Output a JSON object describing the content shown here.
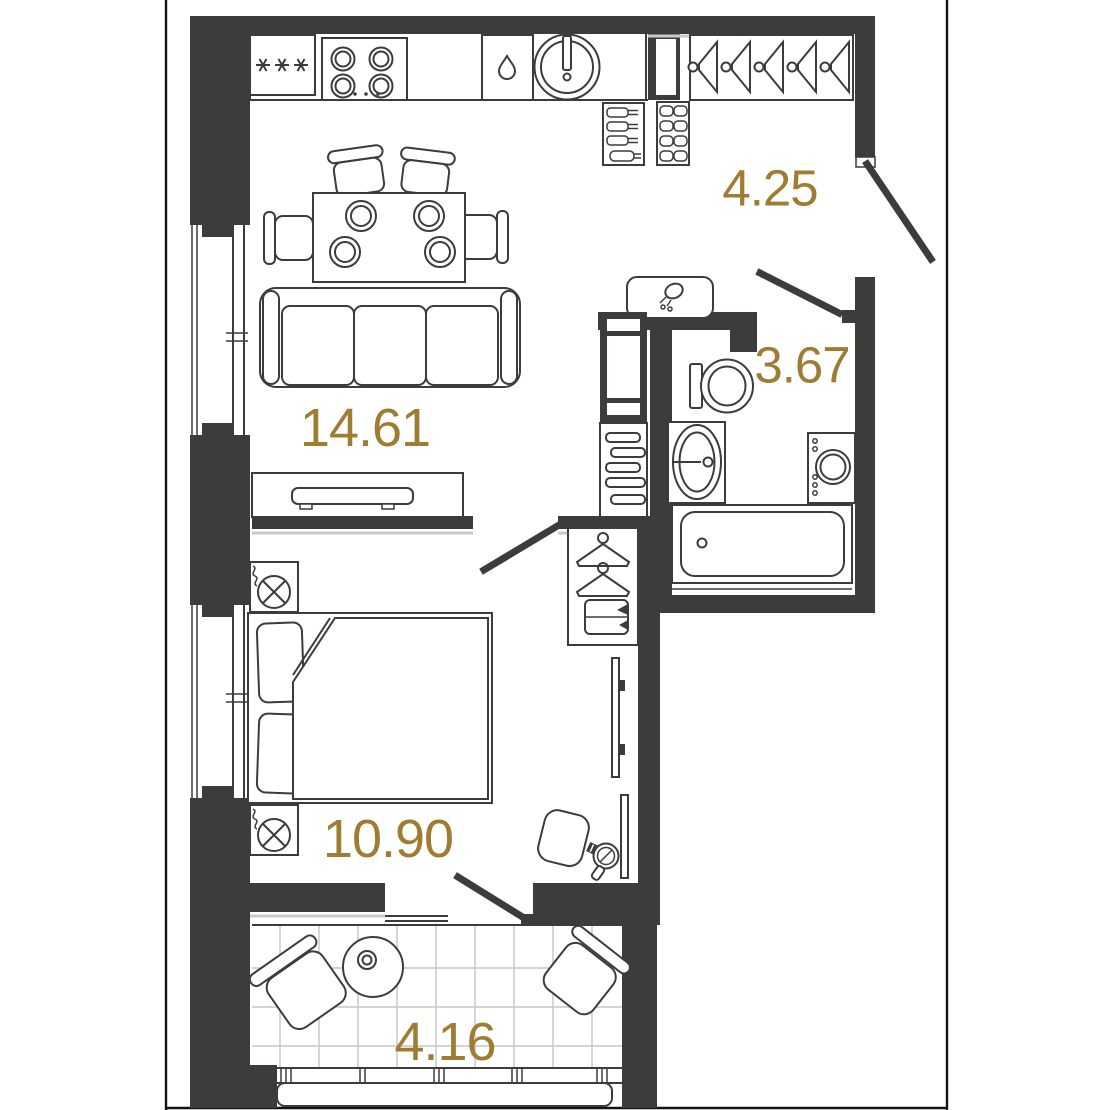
{
  "floorplan": {
    "rooms": [
      {
        "name": "kitchen-living-room",
        "area_label": "14.61"
      },
      {
        "name": "hallway",
        "area_label": "4.25"
      },
      {
        "name": "bathroom",
        "area_label": "3.67"
      },
      {
        "name": "bedroom",
        "area_label": "10.90"
      },
      {
        "name": "balcony",
        "area_label": "4.16"
      }
    ],
    "colors": {
      "wall": "#3d3c3a",
      "area_text": "#9e7d33",
      "outline": "#3d3c3a",
      "frame": "#141414",
      "tile_grid": "#c5c5c5",
      "shadow": "#cbcac8"
    },
    "fixtures": [
      "fridge-icon",
      "stove-icon",
      "dishwasher-icon",
      "sink-icon",
      "wine-rack-icon",
      "vent-shaft",
      "wardrobe-hangers-icon",
      "shoe-rack-icon",
      "water-heater-icon",
      "toilet-icon",
      "washbasin-icon",
      "washing-machine-icon",
      "bathtub-icon",
      "dining-table-icon",
      "sofa-icon",
      "tv-console-icon",
      "cabinet-icon",
      "towel-ladder-icon",
      "hanger-closet-icon",
      "mirror-icon",
      "comb-icon",
      "hand-mirror-icon",
      "desk-chair-icon",
      "nightstand-lamp-icon",
      "bed-icon",
      "balcony-chair-icon",
      "balcony-table-icon"
    ]
  }
}
